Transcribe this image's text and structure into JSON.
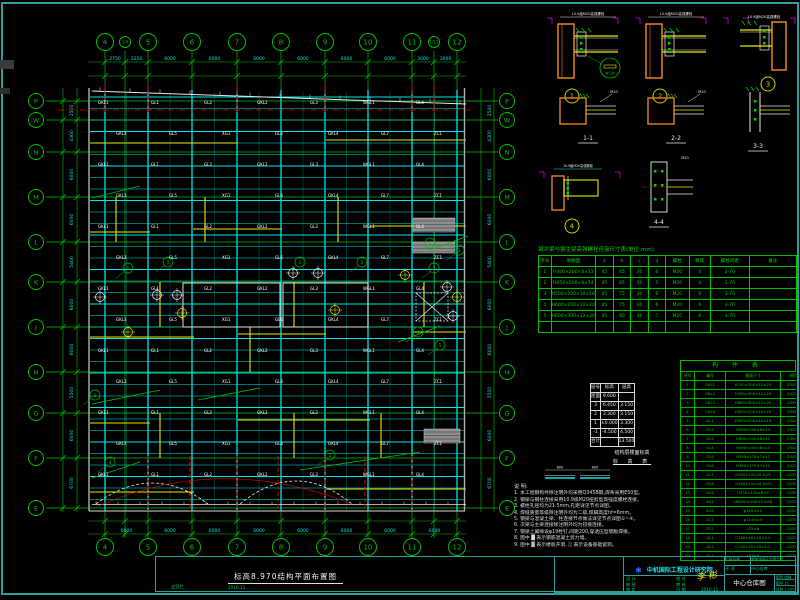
{
  "colors": {
    "frame": "#2f9e9e",
    "grid": "#00c000",
    "cyan": "#00e5e5",
    "yellow": "#e8e800",
    "white": "#e8e8e8",
    "red": "#e00000",
    "orange": "#e8821e",
    "magenta": "#dd00dd",
    "gray": "#9a9a9a",
    "green": "#00d200",
    "blue": "#2d6bff"
  },
  "plan": {
    "title": "标高8.970结构平面布置图",
    "grid_x": [
      {
        "l": "4",
        "x": 105
      },
      {
        "l": "1/4",
        "x": 125,
        "sub": true
      },
      {
        "l": "5",
        "x": 148
      },
      {
        "l": "6",
        "x": 192
      },
      {
        "l": "7",
        "x": 237
      },
      {
        "l": "8",
        "x": 281
      },
      {
        "l": "9",
        "x": 325
      },
      {
        "l": "10",
        "x": 368
      },
      {
        "l": "11",
        "x": 412
      },
      {
        "l": "1/11",
        "x": 434,
        "sub": true
      },
      {
        "l": "12",
        "x": 457
      }
    ],
    "grid_y": [
      {
        "l": "P",
        "y": 101
      },
      {
        "l": "W",
        "y": 120
      },
      {
        "l": "N",
        "y": 152
      },
      {
        "l": "M",
        "y": 197
      },
      {
        "l": "L",
        "y": 242
      },
      {
        "l": "K",
        "y": 282
      },
      {
        "l": "J",
        "y": 327
      },
      {
        "l": "H",
        "y": 372
      },
      {
        "l": "G",
        "y": 413
      },
      {
        "l": "F",
        "y": 458
      },
      {
        "l": "E",
        "y": 508
      }
    ],
    "dims_top": [
      "2750",
      "3250",
      "6000",
      "6000",
      "6000",
      "6000",
      "6000",
      "6000",
      "3000",
      "3000"
    ],
    "dims_bottom": [
      "6000",
      "6000",
      "6000",
      "6000",
      "6000",
      "6000",
      "6000",
      "6000"
    ],
    "dims_left": [
      "2500",
      "4300",
      "6000",
      "6000",
      "5400",
      "6000",
      "6000",
      "5500",
      "6000",
      "6700"
    ],
    "dims_right": [
      "2500",
      "4300",
      "6000",
      "6000",
      "5400",
      "6000",
      "6000",
      "5500",
      "6000",
      "6700"
    ],
    "beam_labels": [
      "GKL1",
      "GL1",
      "GL2",
      "GKL2",
      "GL3",
      "WGL1",
      "GL4",
      "GKL3",
      "GL5",
      "XG1",
      "GL6",
      "GKL4",
      "GL7",
      "ZC1"
    ],
    "red_top_xs": [
      105,
      148,
      237,
      325,
      412,
      434
    ],
    "red_bottom_xs": [
      148,
      190,
      237,
      278,
      325,
      365,
      412
    ],
    "yellow_h": [
      [
        90,
        143,
        238
      ],
      [
        326,
        140,
        466
      ],
      [
        90,
        232,
        150
      ],
      [
        193,
        229,
        282
      ],
      [
        370,
        226,
        466
      ],
      [
        90,
        337,
        194
      ],
      [
        238,
        334,
        326
      ],
      [
        413,
        332,
        466
      ],
      [
        90,
        423,
        150
      ],
      [
        238,
        420,
        370
      ],
      [
        90,
        492,
        194
      ],
      [
        326,
        489,
        466
      ]
    ],
    "yellow_v": [
      [
        116,
        197,
        242
      ],
      [
        160,
        282,
        327
      ],
      [
        205,
        197,
        242
      ],
      [
        250,
        327,
        372
      ],
      [
        294,
        282,
        327
      ],
      [
        338,
        197,
        242
      ],
      [
        381,
        413,
        458
      ],
      [
        424,
        282,
        327
      ],
      [
        160,
        413,
        458
      ],
      [
        294,
        413,
        458
      ]
    ],
    "white_rects": [
      [
        183,
        283,
        97,
        44
      ],
      [
        283,
        283,
        85,
        44
      ]
    ],
    "x_rect": [
      416,
      293,
      32,
      28
    ],
    "hatch_rects": [
      [
        413,
        218,
        42,
        14
      ],
      [
        413,
        242,
        42,
        11
      ],
      [
        424,
        429,
        36,
        14
      ]
    ],
    "green_diags": [
      [
        92,
        404,
        160,
        390
      ],
      [
        198,
        400,
        260,
        388
      ],
      [
        300,
        470,
        420,
        452
      ],
      [
        92,
        478,
        140,
        462
      ],
      [
        430,
        250,
        468,
        236
      ],
      [
        398,
        342,
        440,
        326
      ],
      [
        92,
        198,
        140,
        186
      ]
    ],
    "plus_symbols": [
      [
        157,
        295,
        "w"
      ],
      [
        177,
        295,
        "w"
      ],
      [
        182,
        313,
        "y"
      ],
      [
        293,
        273,
        "w"
      ],
      [
        318,
        273,
        "w"
      ],
      [
        335,
        310,
        "y"
      ],
      [
        405,
        275,
        "y"
      ],
      [
        447,
        287,
        "w"
      ],
      [
        457,
        297,
        "y"
      ],
      [
        453,
        316,
        "w"
      ],
      [
        100,
        297,
        "w"
      ],
      [
        128,
        332,
        "y"
      ]
    ],
    "callouts": [
      [
        430,
        243,
        "1"
      ],
      [
        459,
        250,
        "3"
      ],
      [
        434,
        268,
        "2"
      ],
      [
        418,
        332,
        "4"
      ],
      [
        300,
        262,
        "1"
      ],
      [
        362,
        262,
        "2"
      ],
      [
        128,
        268,
        "5"
      ],
      [
        168,
        262,
        "1"
      ],
      [
        95,
        395,
        "3"
      ],
      [
        440,
        345,
        "1"
      ],
      [
        110,
        462,
        "4"
      ],
      [
        330,
        455,
        "2"
      ]
    ]
  },
  "details": {
    "note": "10.9级M20高强螺栓",
    "weld_note": "坡口焊",
    "items": [
      {
        "kind": "conn",
        "x": 558,
        "y": 24,
        "num": "1",
        "weld": true
      },
      {
        "kind": "conn",
        "x": 646,
        "y": 24,
        "num": "2"
      },
      {
        "kind": "conn3",
        "x": 740,
        "y": 22,
        "num": "3"
      },
      {
        "kind": "sec",
        "x": 560,
        "y": 98,
        "label": "1-1"
      },
      {
        "kind": "sec",
        "x": 648,
        "y": 98,
        "label": "2-2"
      },
      {
        "kind": "sec3",
        "x": 744,
        "y": 92,
        "label": "3-3"
      },
      {
        "kind": "conn4",
        "x": 552,
        "y": 170,
        "num": "4"
      },
      {
        "kind": "sec44",
        "x": 645,
        "y": 162,
        "label": "4-4"
      }
    ]
  },
  "bolt_table": {
    "title": "钢次梁与钢主梁高强螺栓连接尺寸表(单位:mm)",
    "headers": [
      "序号",
      "梁截面",
      "a",
      "b",
      "c",
      "d",
      "螺栓",
      "数量",
      "螺栓间距",
      "备注"
    ],
    "rows": [
      [
        "1",
        "H400×200×8×13",
        "45",
        "45",
        "30",
        "6",
        "M20",
        "4",
        "2-70",
        ""
      ],
      [
        "2",
        "H450×200×8×14",
        "45",
        "85",
        "30",
        "5",
        "M20",
        "4",
        "2-70",
        ""
      ],
      [
        "3",
        "H500×200×10×16",
        "45",
        "75",
        "30",
        "6",
        "M20",
        "6",
        "3-70",
        ""
      ],
      [
        "4",
        "H600×200×10×20",
        "45",
        "75",
        "30",
        "6",
        "M20",
        "6",
        "3-70",
        ""
      ],
      [
        "5",
        "H600×300×12×20",
        "45",
        "90",
        "30",
        "7",
        "M20",
        "6",
        "3-70",
        ""
      ],
      [
        "",
        "",
        "",
        "",
        "",
        "",
        "",
        "",
        "",
        ""
      ]
    ]
  },
  "elevation_table": {
    "headers": [
      "层号",
      "标高",
      "层高"
    ],
    "rows": [
      [
        "屋面",
        "9.600",
        ""
      ],
      [
        "3",
        "6.450",
        "3.150"
      ],
      [
        "2",
        "3.300",
        "3.150"
      ],
      [
        "1",
        "±0.000",
        "3.300"
      ],
      [
        "-1",
        "-4.500",
        "4.500"
      ],
      [
        "合计",
        "",
        "13.500"
      ]
    ],
    "caption1": "结构层楼面标高",
    "caption2": "标 高 表"
  },
  "member_table": {
    "title": "构 件 表",
    "headers": [
      "序号",
      "编号",
      "截面尺寸",
      "材质",
      "备注"
    ],
    "rows": [
      [
        "1",
        "GKL1",
        "H700×300×12×22",
        "Q345B",
        "焊接H型钢"
      ],
      [
        "2",
        "GKL2",
        "H700×300×12×20",
        "Q345B",
        "焊接H型钢"
      ],
      [
        "3",
        "GKL3",
        "H600×300×12×20",
        "Q345B",
        "焊接H型钢"
      ],
      [
        "4",
        "GKL4",
        "H600×200×10×20",
        "Q345B",
        "焊接H型钢"
      ],
      [
        "5",
        "GL1",
        "H500×200×10×16",
        "Q345B",
        "热轧H型钢"
      ],
      [
        "6",
        "GL2",
        "H450×200×8×14",
        "Q345B",
        "热轧H型钢"
      ],
      [
        "7",
        "GL3",
        "H400×200×8×13",
        "Q345B",
        "热轧H型钢"
      ],
      [
        "8",
        "GL4",
        "H400×200×8×13",
        "Q345B",
        "热轧H型钢"
      ],
      [
        "9",
        "GL5",
        "H350×175×7×11",
        "Q345B",
        "热轧H型钢"
      ],
      [
        "10",
        "GL6",
        "H350×175×7×11",
        "Q345B",
        "热轧H型钢"
      ],
      [
        "11",
        "GL7",
        "H300×150×6.5×9",
        "Q235B",
        "热轧H型钢"
      ],
      [
        "12",
        "GL8",
        "H300×150×6.5×9",
        "Q235B",
        "热轧H型钢"
      ],
      [
        "13",
        "GL9",
        "H250×125×6×9",
        "Q235B",
        "热轧H型钢"
      ],
      [
        "14",
        "XG1",
        "HN200×100×5.5×8",
        "Q235B",
        "系杆"
      ],
      [
        "15",
        "XG2",
        "φ140×4.0",
        "Q235B",
        "圆钢管"
      ],
      [
        "16",
        "ZC1",
        "φ114×4.0",
        "Q235B",
        "水平支撑"
      ],
      [
        "17",
        "ZC2",
        "L75×6",
        "Q235B",
        "角钢支撑"
      ],
      [
        "18",
        "QL1",
        "C160×60×20×2.5",
        "Q235B",
        "冷弯薄壁型钢"
      ],
      [
        "19",
        "QL2",
        "C140×50×20×2.2",
        "Q235B",
        "冷弯薄壁型钢"
      ],
      [
        "20",
        "TL1",
        "L63×5",
        "Q235B",
        "拉条"
      ]
    ]
  },
  "notes": {
    "heading": "说 明:",
    "lines": [
      "1. 本工程钢构件除注明外均采用Q345B钢,焊条采用E50型。",
      "2. 钢梁与钢柱连接采用10.9级M20扭剪型高强度螺栓连接。",
      "3. 螺栓孔径均为21.5mm,孔距详见节点详图。",
      "4. 焊缝质量等级除注明外均为二级,焊脚高度hf=6mm。",
      "5. 钢梁与混凝土梁、柱连接节点做法详见节点详图①~④。",
      "6. 次梁与主梁连接除注明外均为铰接连接。",
      "7. 钢梁上翼缘设φ19栓钉,间距200,穿透压型钢板焊接。",
      "8. 图中 █ 表示钢筋混凝土剪力墙。",
      "9. 图中 ▓ 表示楼板开洞, ░ 表示设备基础留洞。"
    ],
    "sketch_dim": "600"
  },
  "title_block": {
    "company": "中机国际工程设计研究院",
    "sign_grid": [
      "设 计",
      "",
      "校 对",
      "",
      "制 图",
      "",
      "审 核",
      "",
      "审 定",
      "",
      "日 期",
      "2010.11"
    ],
    "stamp": "李 彬",
    "project_label": "工程名称",
    "project": "某物流园区仓储工程",
    "subitem_label": "子 项",
    "subitem": "中心仓库",
    "title_text": "中心仓库图",
    "side_cells": [
      [
        "图别",
        "结施"
      ],
      [
        "图号",
        "15"
      ],
      [
        "比例",
        "1:100"
      ]
    ],
    "strip_left": "会签栏",
    "strip_date": "2010.11"
  }
}
